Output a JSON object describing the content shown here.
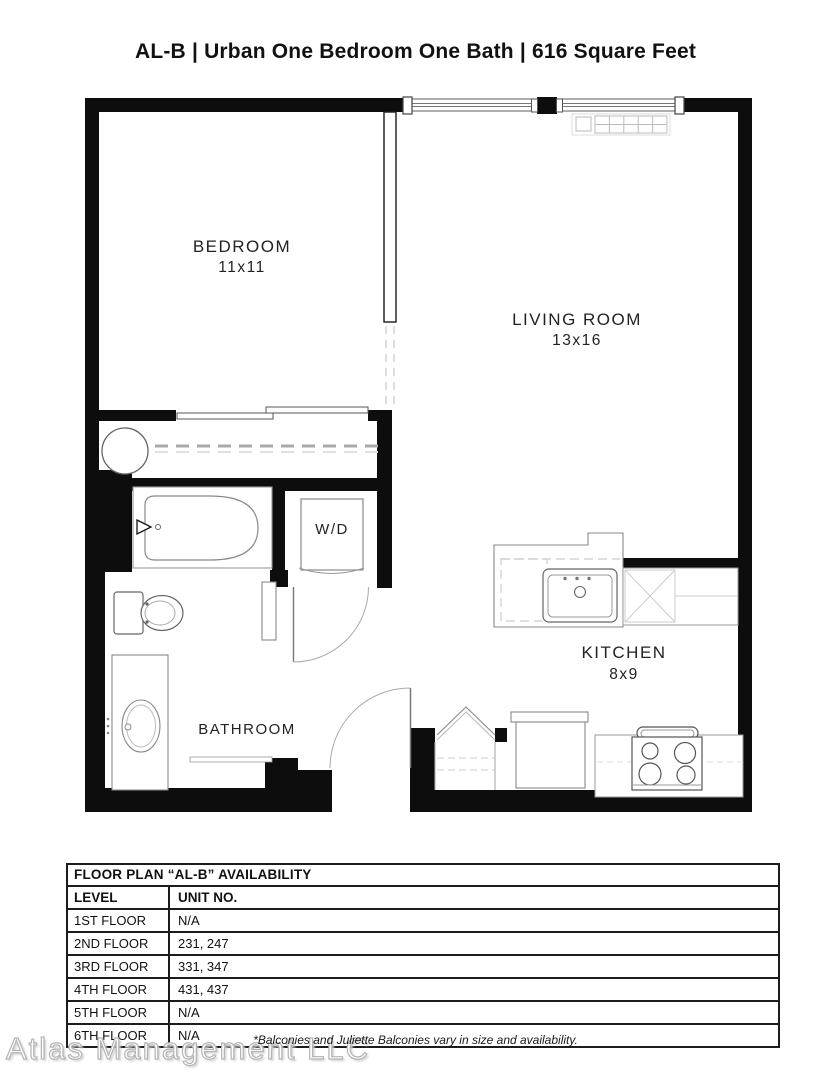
{
  "title": "AL-B | Urban One Bedroom One Bath | 616 Square Feet",
  "floor_plan": {
    "rooms": {
      "bedroom": {
        "name": "BEDROOM",
        "dims": "11x11"
      },
      "living_room": {
        "name": "LIVING ROOM",
        "dims": "13x16"
      },
      "kitchen": {
        "name": "KITCHEN",
        "dims": "8x9"
      },
      "bathroom": {
        "name": "BATHROOM"
      },
      "washer_dryer": {
        "label": "W/D"
      }
    },
    "colors": {
      "wall": "#0d0d0d",
      "fixture_line": "#8a8a8a",
      "background": "#ffffff"
    }
  },
  "availability_table": {
    "title": "FLOOR PLAN “AL-B” AVAILABILITY",
    "columns": [
      "LEVEL",
      "UNIT NO."
    ],
    "rows": [
      {
        "level": "1ST FLOOR",
        "units": "N/A"
      },
      {
        "level": "2ND FLOOR",
        "units": "231, 247"
      },
      {
        "level": "3RD FLOOR",
        "units": "331, 347"
      },
      {
        "level": "4TH FLOOR",
        "units": "431, 437"
      },
      {
        "level": "5TH FLOOR",
        "units": "N/A"
      },
      {
        "level": "6TH FLOOR",
        "units": "N/A"
      }
    ]
  },
  "footnote": "*Balconies and Juliette Balconies vary in size and availability.",
  "watermark": "Atlas Management LLC"
}
